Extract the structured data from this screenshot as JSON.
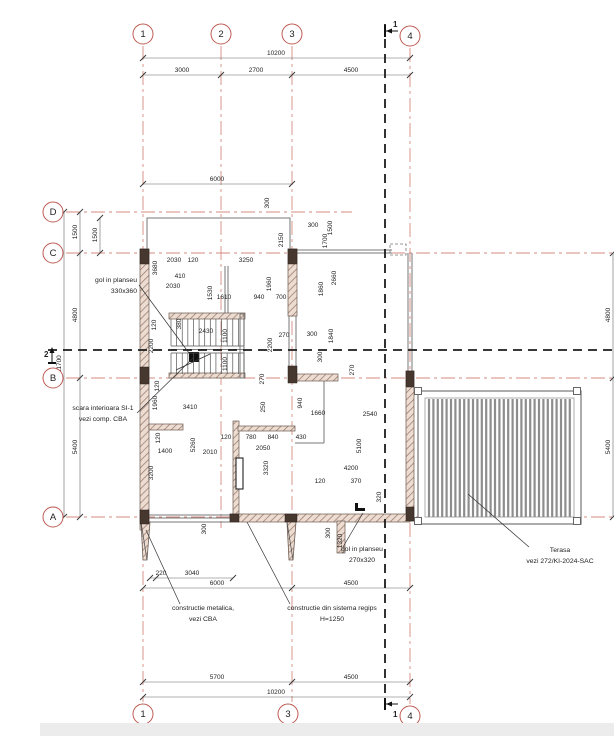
{
  "title": "floor-plan",
  "colors": {
    "grid": "#d4897f",
    "bubble_stroke": "#bf5b53",
    "section": "#1c1c1c",
    "dim_line": "#666666",
    "dim_text": "#222222",
    "wall_hatch_bg": "#ecdcd2",
    "wall_hatch_line": "#9b7a6a",
    "wall_dark": "#46372f",
    "thin": "#777777",
    "terrace_slat": "#8d8d8d"
  },
  "grid": {
    "vertical": [
      {
        "id": "1",
        "x": 103,
        "y1": 30,
        "y2": 686
      },
      {
        "id": "2",
        "x": 181,
        "y1": 30,
        "y2": 512
      },
      {
        "id": "3",
        "x": 252,
        "y1": 30,
        "y2": 686
      },
      {
        "id": "4",
        "x": 370,
        "y1": 32,
        "y2": 688
      }
    ],
    "horizontal": [
      {
        "id": "D",
        "y": 196,
        "x1": 26,
        "x2": 312
      },
      {
        "id": "C",
        "y": 237,
        "x1": 26,
        "x2": 589
      },
      {
        "id": "B",
        "y": 362,
        "x1": 26,
        "x2": 589
      },
      {
        "id": "A",
        "y": 501,
        "x1": 26,
        "x2": 589
      }
    ]
  },
  "bubbles": [
    {
      "id": "1",
      "x": 103,
      "y": 18
    },
    {
      "id": "2",
      "x": 181,
      "y": 18
    },
    {
      "id": "3",
      "x": 252,
      "y": 18
    },
    {
      "id": "4",
      "x": 370,
      "y": 20
    },
    {
      "id": "1",
      "x": 103,
      "y": 698
    },
    {
      "id": "3",
      "x": 248,
      "y": 698
    },
    {
      "id": "4",
      "x": 370,
      "y": 700
    },
    {
      "id": "D",
      "x": 13,
      "y": 196
    },
    {
      "id": "C",
      "x": 13,
      "y": 237
    },
    {
      "id": "B",
      "x": 13,
      "y": 362
    },
    {
      "id": "A",
      "x": 13,
      "y": 501
    },
    {
      "id": "C",
      "x": 601,
      "y": 237
    },
    {
      "id": "B",
      "x": 601,
      "y": 362
    },
    {
      "id": "A",
      "x": 601,
      "y": 501
    }
  ],
  "section_lines": [
    {
      "name": "section-line-1",
      "x1": 345,
      "y1": 8,
      "x2": 345,
      "y2": 688
    },
    {
      "name": "section-line-2",
      "x1": 8,
      "y1": 334,
      "x2": 600,
      "y2": 334
    }
  ],
  "markers": [
    {
      "label": "1",
      "bar": [
        345,
        9,
        345,
        21
      ],
      "arrow": [
        358,
        15,
        346,
        15
      ],
      "tx": 353,
      "ty": 11
    },
    {
      "label": "1",
      "bar": [
        345,
        682,
        345,
        694
      ],
      "arrow": [
        358,
        688,
        346,
        688
      ],
      "tx": 353,
      "ty": 701
    },
    {
      "label": "2",
      "bar": [
        8,
        347,
        16,
        347
      ],
      "arrow": [
        12,
        347,
        12,
        332
      ],
      "tx": 4,
      "ty": 341
    },
    {
      "label": "2",
      "bar": [
        591,
        347,
        599,
        347
      ],
      "arrow": [
        595,
        347,
        595,
        332
      ],
      "tx": 604,
      "ty": 341
    }
  ],
  "walls": [
    [
      100,
      233,
      9,
      281
    ],
    [
      248,
      233,
      9,
      67
    ],
    [
      257,
      358,
      41,
      7
    ],
    [
      366,
      355,
      8,
      150
    ],
    [
      190,
      498,
      180,
      8
    ],
    [
      193,
      405,
      6,
      93
    ],
    [
      109,
      408,
      34,
      6
    ],
    [
      198,
      410,
      57,
      5
    ],
    [
      297,
      505,
      8,
      32
    ],
    [
      129,
      297,
      76,
      6
    ],
    [
      129,
      357,
      76,
      5
    ]
  ],
  "dark_blocks": [
    [
      100,
      233,
      9,
      15
    ],
    [
      100,
      351,
      9,
      17
    ],
    [
      100,
      494,
      9,
      14
    ],
    [
      248,
      233,
      9,
      15
    ],
    [
      248,
      350,
      9,
      17
    ],
    [
      366,
      355,
      8,
      16
    ],
    [
      366,
      491,
      8,
      14
    ],
    [
      245,
      498,
      12,
      8
    ],
    [
      190,
      498,
      9,
      8
    ]
  ],
  "black_bits": [
    [
      149,
      336,
      10,
      10
    ],
    [
      315,
      492,
      10,
      3
    ],
    [
      315,
      487,
      3,
      8
    ]
  ],
  "buttresses": [
    {
      "pts": "101,506 110,506 107,544 103,544",
      "diag": [
        101,
        506,
        107,
        544
      ]
    },
    {
      "pts": "247,506 256,506 253,544 249,544",
      "diag": [
        247,
        506,
        253,
        544
      ]
    }
  ],
  "thin_lines": [
    {
      "pts": [
        [
          107,
          233
        ],
        [
          107,
          202
        ],
        [
          250,
          202
        ],
        [
          250,
          233
        ]
      ]
    },
    {
      "pts": [
        [
          257,
          234
        ],
        [
          352,
          234
        ]
      ]
    },
    {
      "pts": [
        [
          257,
          237
        ],
        [
          352,
          237
        ]
      ]
    },
    {
      "pts": [
        [
          249,
          300
        ],
        [
          249,
          350
        ]
      ]
    },
    {
      "pts": [
        [
          256,
          300
        ],
        [
          256,
          350
        ]
      ]
    },
    {
      "pts": [
        [
          109,
          499
        ],
        [
          190,
          499
        ]
      ]
    },
    {
      "pts": [
        [
          109,
          502
        ],
        [
          190,
          502
        ]
      ]
    },
    {
      "pts": [
        [
          109,
          506
        ],
        [
          190,
          506
        ]
      ]
    },
    {
      "pts": [
        [
          284,
          365
        ],
        [
          284,
          427
        ]
      ]
    },
    {
      "pts": [
        [
          255,
          427
        ],
        [
          284,
          427
        ]
      ]
    },
    {
      "pts": [
        [
          185,
          250
        ],
        [
          185,
          297
        ]
      ]
    },
    {
      "pts": [
        [
          188,
          250
        ],
        [
          188,
          297
        ]
      ]
    },
    {
      "pts": [
        [
          368,
          237
        ],
        [
          368,
          355
        ]
      ]
    },
    {
      "pts": [
        [
          372,
          237
        ],
        [
          372,
          355
        ]
      ]
    }
  ],
  "dashed_rect": [
    350,
    228,
    16,
    11
  ],
  "door": [
    196,
    442,
    7,
    31
  ],
  "stair": {
    "x1": 131,
    "x2": 204,
    "top": 303,
    "mid1": 330,
    "mid2": 337,
    "bot": 358,
    "treads": 13,
    "rail_ys": [
      330,
      333.5,
      337
    ],
    "side": [
      200,
      298,
      4,
      64
    ],
    "arrow": [
      136,
      354,
      170,
      338
    ]
  },
  "terrace": {
    "x": 378,
    "y": 375,
    "w": 163,
    "h": 133,
    "inner": [
      385,
      382,
      149,
      119
    ],
    "slat_from": 389,
    "slat_to": 531,
    "slat_step": 4.4,
    "slat_y1": 383,
    "slat_y2": 501,
    "corners": [
      [
        374.5,
        371.5
      ],
      [
        533.5,
        371.5
      ],
      [
        374.5,
        501.5
      ],
      [
        533.5,
        501.5
      ]
    ],
    "corner_size": 7
  },
  "dim_chains": [
    {
      "o": "h",
      "line": 42,
      "from": 103,
      "to": 370,
      "ticks": [
        103,
        370
      ],
      "labels": [
        {
          "t": "10200",
          "at": 236
        }
      ]
    },
    {
      "o": "h",
      "line": 59,
      "from": 103,
      "to": 370,
      "ticks": [
        103,
        181,
        252,
        370
      ],
      "labels": [
        {
          "t": "3000",
          "at": 142
        },
        {
          "t": "2700",
          "at": 216
        },
        {
          "t": "4500",
          "at": 311
        }
      ]
    },
    {
      "o": "h",
      "line": 168,
      "from": 103,
      "to": 252,
      "ticks": [
        103,
        252
      ],
      "labels": [
        {
          "t": "6000",
          "at": 177
        }
      ]
    },
    {
      "o": "h",
      "line": 562,
      "from": 110,
      "to": 193,
      "ticks": [
        110,
        116,
        193
      ],
      "labels": [
        {
          "t": "220",
          "at": 121
        },
        {
          "t": "3040",
          "at": 152
        }
      ]
    },
    {
      "o": "h",
      "line": 572,
      "from": 103,
      "to": 370,
      "ticks": [
        103,
        252,
        370
      ],
      "labels": [
        {
          "t": "6000",
          "at": 177
        },
        {
          "t": "4500",
          "at": 311
        }
      ]
    },
    {
      "o": "h",
      "line": 666,
      "from": 103,
      "to": 370,
      "ticks": [
        103,
        252,
        370
      ],
      "labels": [
        {
          "t": "5700",
          "at": 177
        },
        {
          "t": "4500",
          "at": 311
        }
      ]
    },
    {
      "o": "h",
      "line": 681,
      "from": 103,
      "to": 370,
      "ticks": [
        103,
        370
      ],
      "labels": [
        {
          "t": "10200",
          "at": 236
        }
      ]
    },
    {
      "o": "v",
      "line": 24,
      "from": 196,
      "to": 501,
      "ticks": [
        196,
        501
      ],
      "labels": [
        {
          "t": "11700",
          "at": 348
        }
      ]
    },
    {
      "o": "v",
      "line": 40,
      "from": 196,
      "to": 501,
      "ticks": [
        196,
        237,
        362,
        501
      ],
      "labels": [
        {
          "t": "1500",
          "at": 216
        },
        {
          "t": "4800",
          "at": 299
        },
        {
          "t": "5400",
          "at": 431
        }
      ]
    },
    {
      "o": "v",
      "line": 60,
      "from": 202,
      "to": 237,
      "ticks": [
        202,
        237
      ],
      "labels": [
        {
          "t": "1500",
          "at": 219
        }
      ]
    },
    {
      "o": "v",
      "line": 573,
      "from": 237,
      "to": 501,
      "ticks": [
        237,
        362,
        501
      ],
      "labels": [
        {
          "t": "4800",
          "at": 299
        },
        {
          "t": "5400",
          "at": 431
        }
      ]
    },
    {
      "o": "v",
      "line": 588,
      "from": 237,
      "to": 501,
      "ticks": [
        237,
        501
      ],
      "labels": [
        {
          "t": "10200",
          "at": 395
        }
      ]
    }
  ],
  "dim_free": [
    {
      "t": "300",
      "o": "v",
      "x": 229,
      "y": 187
    },
    {
      "t": "300",
      "o": "h",
      "x": 273,
      "y": 211
    },
    {
      "t": "1500",
      "o": "v",
      "x": 292,
      "y": 212
    },
    {
      "t": "2150",
      "o": "v",
      "x": 243,
      "y": 224
    },
    {
      "t": "1700",
      "o": "v",
      "x": 287,
      "y": 225
    },
    {
      "t": "2660",
      "o": "v",
      "x": 296,
      "y": 262
    },
    {
      "t": "3680",
      "o": "v",
      "x": 117,
      "y": 252
    },
    {
      "t": "2030",
      "o": "h",
      "x": 134,
      "y": 246
    },
    {
      "t": "120",
      "o": "h",
      "x": 153,
      "y": 246
    },
    {
      "t": "3250",
      "o": "h",
      "x": 206,
      "y": 246
    },
    {
      "t": "410",
      "o": "h",
      "x": 140,
      "y": 262
    },
    {
      "t": "2030",
      "o": "h",
      "x": 133,
      "y": 272
    },
    {
      "t": "1530",
      "o": "v",
      "x": 172,
      "y": 277
    },
    {
      "t": "1610",
      "o": "h",
      "x": 184,
      "y": 283
    },
    {
      "t": "940",
      "o": "h",
      "x": 219,
      "y": 283
    },
    {
      "t": "700",
      "o": "h",
      "x": 241,
      "y": 283
    },
    {
      "t": "1960",
      "o": "v",
      "x": 231,
      "y": 268
    },
    {
      "t": "1860",
      "o": "v",
      "x": 283,
      "y": 273
    },
    {
      "t": "120",
      "o": "v",
      "x": 116,
      "y": 309
    },
    {
      "t": "380",
      "o": "v",
      "x": 141,
      "y": 308
    },
    {
      "t": "2430",
      "o": "h",
      "x": 166,
      "y": 317
    },
    {
      "t": "1100",
      "o": "v",
      "x": 187,
      "y": 320
    },
    {
      "t": "1100",
      "o": "v",
      "x": 187,
      "y": 348
    },
    {
      "t": "2200",
      "o": "v",
      "x": 113,
      "y": 330
    },
    {
      "t": "2200",
      "o": "v",
      "x": 232,
      "y": 329
    },
    {
      "t": "270",
      "o": "h",
      "x": 244,
      "y": 321
    },
    {
      "t": "300",
      "o": "h",
      "x": 272,
      "y": 320
    },
    {
      "t": "1840",
      "o": "v",
      "x": 293,
      "y": 320
    },
    {
      "t": "300",
      "o": "v",
      "x": 282,
      "y": 341
    },
    {
      "t": "270",
      "o": "v",
      "x": 224,
      "y": 363
    },
    {
      "t": "250",
      "o": "v",
      "x": 225,
      "y": 391
    },
    {
      "t": "940",
      "o": "v",
      "x": 262,
      "y": 387
    },
    {
      "t": "1660",
      "o": "h",
      "x": 278,
      "y": 399
    },
    {
      "t": "2540",
      "o": "h",
      "x": 330,
      "y": 400
    },
    {
      "t": "270",
      "o": "v",
      "x": 314,
      "y": 354
    },
    {
      "t": "5100",
      "o": "v",
      "x": 321,
      "y": 430
    },
    {
      "t": "1960",
      "o": "v",
      "x": 117,
      "y": 387
    },
    {
      "t": "120",
      "o": "v",
      "x": 119,
      "y": 370
    },
    {
      "t": "3410",
      "o": "h",
      "x": 150,
      "y": 393
    },
    {
      "t": "120",
      "o": "v",
      "x": 120,
      "y": 422
    },
    {
      "t": "1400",
      "o": "h",
      "x": 125,
      "y": 437
    },
    {
      "t": "5260",
      "o": "v",
      "x": 155,
      "y": 429
    },
    {
      "t": "2010",
      "o": "h",
      "x": 170,
      "y": 438
    },
    {
      "t": "3200",
      "o": "v",
      "x": 113,
      "y": 457
    },
    {
      "t": "120",
      "o": "h",
      "x": 186,
      "y": 423
    },
    {
      "t": "780",
      "o": "h",
      "x": 211,
      "y": 423
    },
    {
      "t": "840",
      "o": "h",
      "x": 233,
      "y": 423
    },
    {
      "t": "430",
      "o": "h",
      "x": 261,
      "y": 423
    },
    {
      "t": "2050",
      "o": "h",
      "x": 223,
      "y": 434
    },
    {
      "t": "3320",
      "o": "v",
      "x": 228,
      "y": 452
    },
    {
      "t": "4200",
      "o": "h",
      "x": 311,
      "y": 454
    },
    {
      "t": "120",
      "o": "h",
      "x": 280,
      "y": 467
    },
    {
      "t": "370",
      "o": "h",
      "x": 316,
      "y": 467
    },
    {
      "t": "320",
      "o": "v",
      "x": 341,
      "y": 481
    },
    {
      "t": "300",
      "o": "v",
      "x": 290,
      "y": 517
    },
    {
      "t": "1320",
      "o": "v",
      "x": 302,
      "y": 525
    },
    {
      "t": "300",
      "o": "v",
      "x": 166,
      "y": 513
    }
  ],
  "labels": [
    {
      "name": "label-gol-planseu-330",
      "lines": [
        "gol in planseu",
        "330x360"
      ],
      "x": 97,
      "y": 266,
      "anchor": "end",
      "leader": [
        99,
        269,
        149,
        337
      ]
    },
    {
      "name": "label-scara-interioara",
      "lines": [
        "scara interioara SI-1",
        "vezi comp. CBA"
      ],
      "x": 63,
      "y": 394,
      "anchor": "middle",
      "leader": [
        97,
        397,
        153,
        342
      ]
    },
    {
      "name": "label-constructie-metalica",
      "lines": [
        "constructie metalica,",
        "vezi CBA"
      ],
      "x": 163,
      "y": 594,
      "anchor": "middle",
      "leader": [
        140,
        588,
        106,
        514
      ]
    },
    {
      "name": "label-constructie-regips",
      "lines": [
        "constructie din sistema regips",
        "H=1250"
      ],
      "x": 292,
      "y": 594,
      "anchor": "middle",
      "leader": [
        250,
        588,
        207,
        506
      ]
    },
    {
      "name": "label-gol-planseu-270",
      "lines": [
        "gol in planseu",
        "270x320"
      ],
      "x": 322,
      "y": 535,
      "anchor": "middle",
      "leader": [
        303,
        531,
        323,
        497
      ]
    },
    {
      "name": "label-terasa",
      "lines": [
        "Terasa",
        "vezi 272/KI-2024-SAC"
      ],
      "x": 520,
      "y": 536,
      "anchor": "middle",
      "leader": [
        489,
        531,
        428,
        478
      ]
    }
  ]
}
